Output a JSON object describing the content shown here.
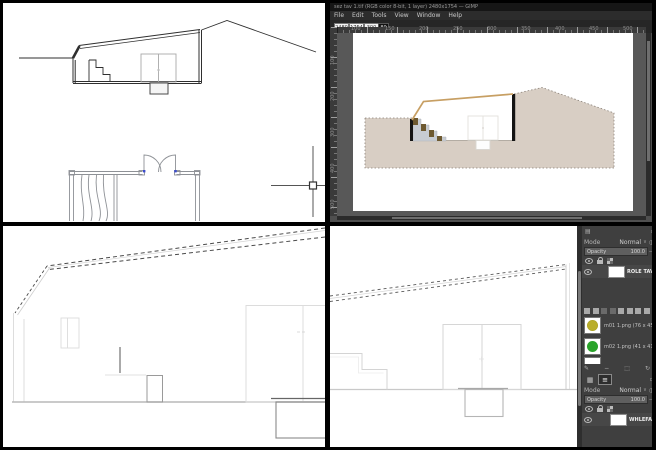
{
  "colors": {
    "ground_tan": "#d8cec4",
    "roof_tan": "#c79f63",
    "step_brown": "#6d5930",
    "stair_gray": "#c7ccd2",
    "wall_black": "#141414",
    "hinge_blue": "#3b4bce",
    "ui_dark": "#3f3f3f",
    "ui_darker": "#2c2c2c",
    "brush_olive": "#b9ae2a",
    "brush_green": "#2aa42a"
  },
  "editor": {
    "title": "sez tav 1.tif (RGB color 8-bit, 1 layer) 2480x1754 — GIMP",
    "menus": [
      "File",
      "Edit",
      "Tools",
      "View",
      "Window",
      "Help"
    ],
    "tool_fields": [
      "2480",
      "1754",
      "300"
    ],
    "zoom_badge": "80",
    "ruler_top_labels": [
      "100",
      "150",
      "200",
      "250",
      "300",
      "350",
      "400",
      "450",
      "500"
    ],
    "ruler_left_labels": [
      "100",
      "200",
      "300",
      "400",
      "500"
    ]
  },
  "dock": {
    "dialog1": {
      "mode_label": "Mode",
      "mode_value": "Normal",
      "opacity_label": "Opacity",
      "opacity_value": "100.0",
      "minus": "−",
      "layer_name": "ROLE TAV 1.p"
    },
    "brushes": [
      {
        "name": "m01 1.png (76 x 45)"
      },
      {
        "name": "m02 1.png (41 x 41)"
      }
    ],
    "dialog2": {
      "mode_label": "Mode",
      "mode_value": "Normal",
      "opacity_label": "Opacity",
      "opacity_value": "100.0",
      "minus": "−",
      "layer_name": "WHLEFAX 1.p"
    },
    "footer_icons": [
      "✎",
      "−",
      "⬚",
      "↻"
    ],
    "tab_grid": "▦",
    "tab_list": "≡",
    "chevron": "∨",
    "mode_icon": "◑",
    "header_icon": "▤"
  }
}
